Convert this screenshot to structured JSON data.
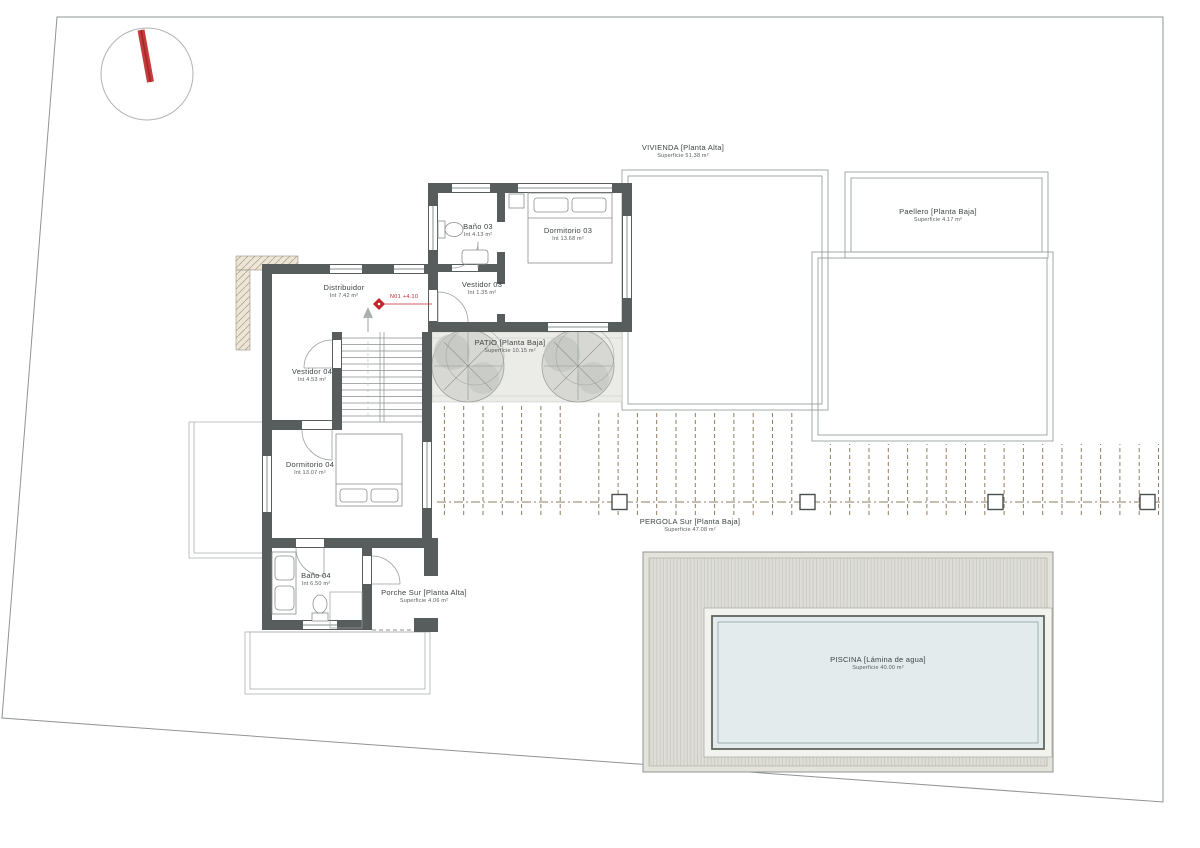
{
  "labels": {
    "vivienda": {
      "name": "VIVIENDA [Planta Alta]",
      "area": "Superficie 51.38 m²"
    },
    "paellero": {
      "name": "Paellero [Planta Baja]",
      "area": "Superficie 4.17 m²"
    },
    "bano03": {
      "name": "Baño 03",
      "area": "Int 4.13 m²"
    },
    "dormitorio03": {
      "name": "Dormitorio 03",
      "area": "Int 13.68 m²"
    },
    "vestidor03": {
      "name": "Vestidor 03",
      "area": "Int 1.35 m²"
    },
    "distribuidor": {
      "name": "Distribuidor",
      "area": "Int 7.42 m²"
    },
    "vestidor04": {
      "name": "Vestidor 04",
      "area": "Int 4.53 m²"
    },
    "dormitorio04": {
      "name": "Dormitorio 04",
      "area": "Int 13.07 m²"
    },
    "bano04": {
      "name": "Baño 04",
      "area": "Int 6.50 m²"
    },
    "porche": {
      "name": "Porche Sur [Planta Alta]",
      "area": "Superficie 4.06 m²"
    },
    "patio": {
      "name": "PATIO [Planta Baja]",
      "area": "Superficie 10.15 m²"
    },
    "pergola": {
      "name": "PERGOLA Sur [Planta Baja]",
      "area": "Superficie 47.08 m²"
    },
    "piscina": {
      "name": "PISCINA [Lámina de agua]",
      "area": "Superficie 40.00 m²"
    }
  },
  "annotations": {
    "level_marker": "N01 +4.10"
  },
  "colors": {
    "accent_red": "#c0272d",
    "wall_gray": "#575c5c",
    "pool_water": "#e3ebec",
    "pergola_dash": "#8d7a5f"
  }
}
